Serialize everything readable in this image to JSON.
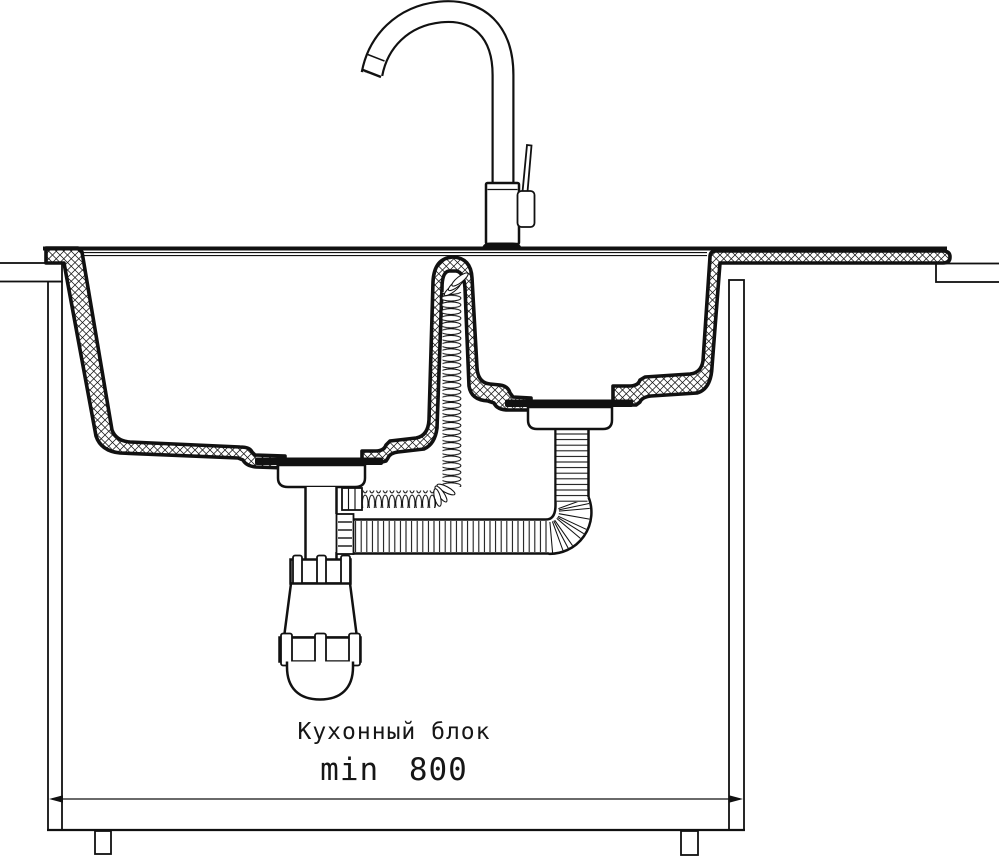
{
  "title": "Kitchen sink installation cross-section drawing",
  "colors": {
    "ink": "#111111",
    "background": "#ffffff"
  },
  "labels": {
    "cabinet_name": "Кухонный блок",
    "cabinet_min_width": "min 800"
  }
}
